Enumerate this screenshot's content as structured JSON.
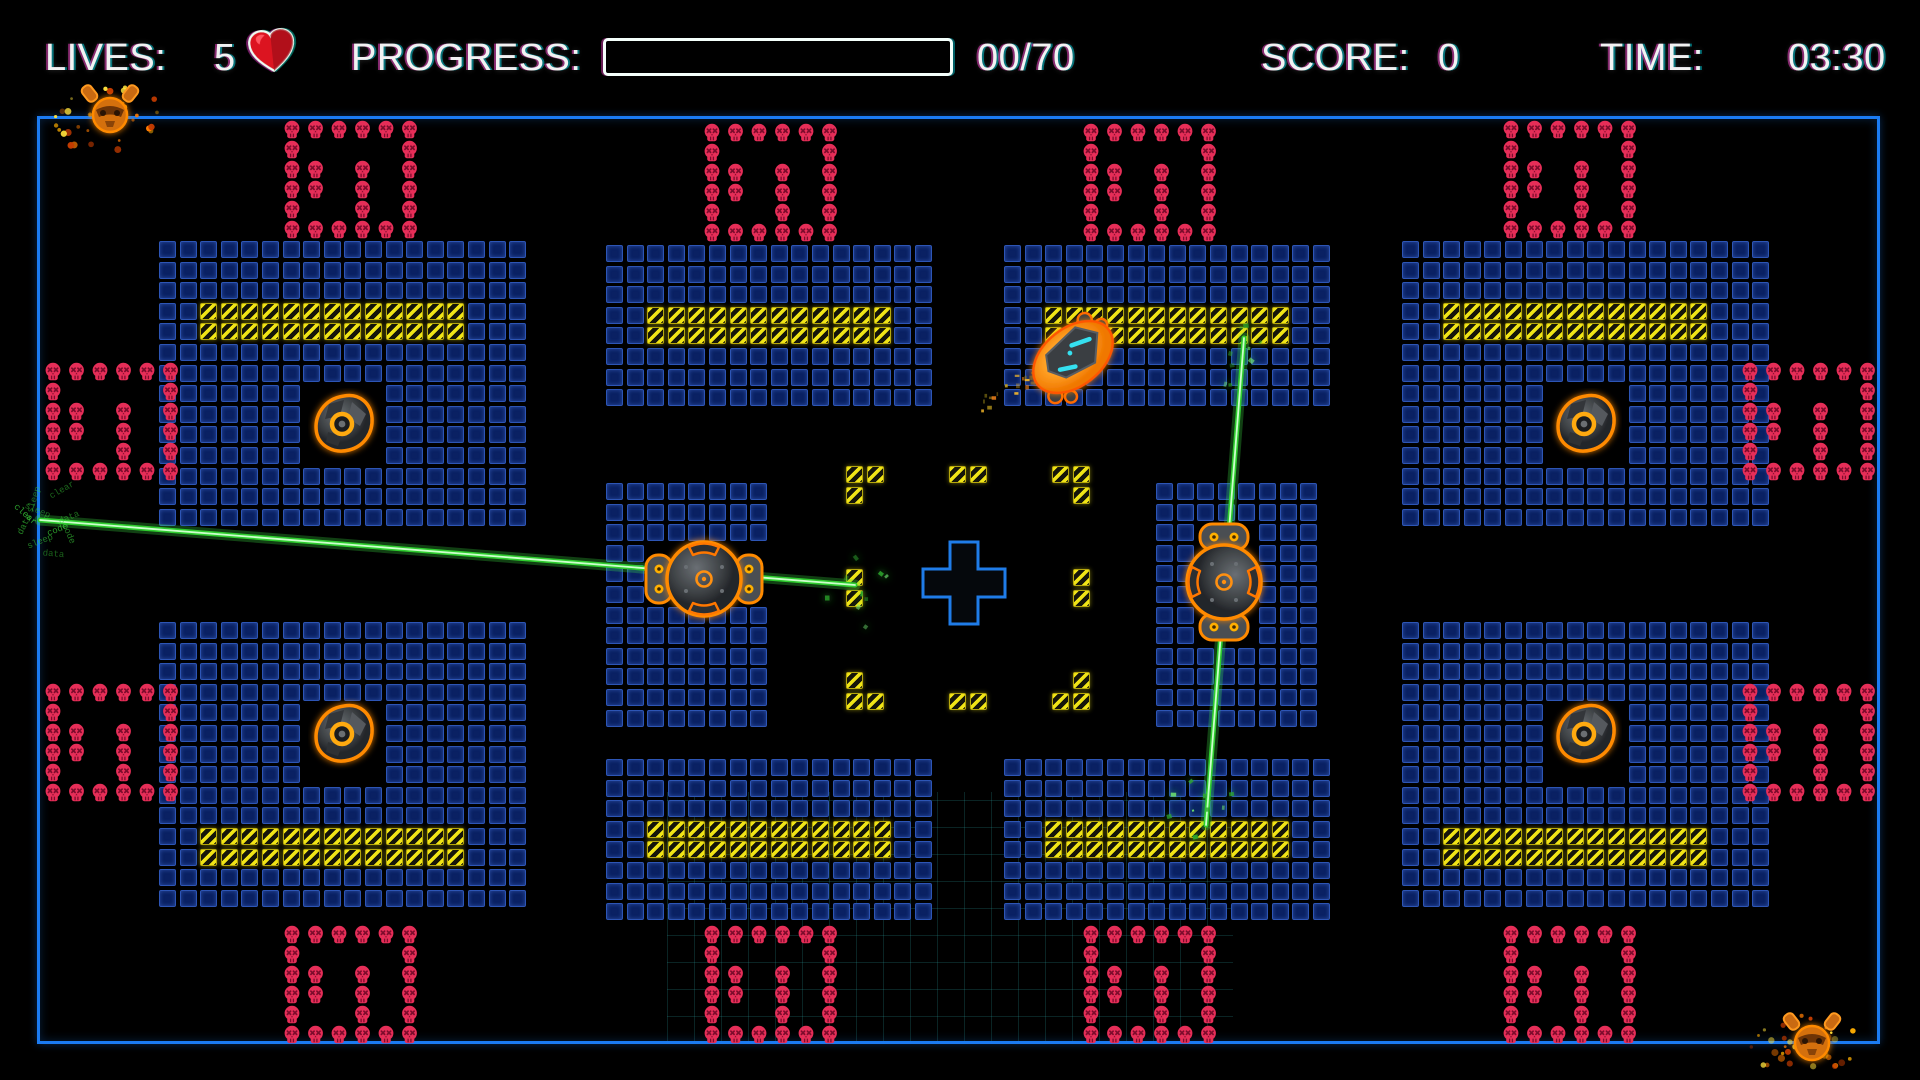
{
  "hud": {
    "lives_label": "LIVES:",
    "lives_value": "5",
    "heart_icon": "heart",
    "progress_label": "PROGRESS:",
    "progress_value": "00/70",
    "progress_fraction": 0,
    "score_label": "SCORE:",
    "score_value": "0",
    "time_label": "TIME:",
    "time_value": "03:30"
  },
  "colors": {
    "background": "#000000",
    "hud_text": "#f2f2f2",
    "field_border": "#1b7bf2",
    "tile_fill": "#0a2163",
    "tile_border": "#2d55b5",
    "hazard_yellow": "#f0e416",
    "hazard_dark": "#15150a",
    "skull": "#e62e58",
    "skull_detail": "#7d0c2c",
    "laser_green": "#2ecc2e",
    "enemy_gray": "#44484c",
    "enemy_outline": "#ff8a00",
    "player_orange": "#ffa024",
    "player_accent": "#35e0f0",
    "heart_red": "#dc1420",
    "grid_teal": "rgba(45,165,165,0.22)"
  },
  "field": {
    "x": 37,
    "y": 116,
    "w": 1843,
    "h": 928
  },
  "tile_pitch": 20.6,
  "tile_size": 17,
  "tile_blocks": [
    {
      "x": 159,
      "y": 241,
      "cols": 18,
      "rows": 14,
      "hazard": {
        "rows": [
          3,
          4
        ],
        "c0": 2,
        "c1": 14
      },
      "hole": {
        "r0": 7,
        "r1": 10,
        "c0": 7,
        "c1": 10
      }
    },
    {
      "x": 606,
      "y": 245,
      "cols": 16,
      "rows": 8,
      "hazard": {
        "rows": [
          3,
          4
        ],
        "c0": 2,
        "c1": 13
      }
    },
    {
      "x": 1004,
      "y": 245,
      "cols": 16,
      "rows": 8,
      "hazard": {
        "rows": [
          3,
          4
        ],
        "c0": 2,
        "c1": 13
      }
    },
    {
      "x": 1402,
      "y": 241,
      "cols": 18,
      "rows": 14,
      "hazard": {
        "rows": [
          3,
          4
        ],
        "c0": 2,
        "c1": 14
      },
      "hole": {
        "r0": 7,
        "r1": 10,
        "c0": 7,
        "c1": 10
      }
    },
    {
      "x": 606,
      "y": 483,
      "cols": 8,
      "rows": 12,
      "hole": {
        "r0": 3,
        "r1": 5,
        "c0": 2,
        "c1": 7
      }
    },
    {
      "x": 1156,
      "y": 483,
      "cols": 8,
      "rows": 12,
      "hole": {
        "r0": 2,
        "r1": 7,
        "c0": 2,
        "c1": 4
      }
    },
    {
      "x": 159,
      "y": 622,
      "cols": 18,
      "rows": 14,
      "hazard": {
        "rows": [
          10,
          11
        ],
        "c0": 2,
        "c1": 14
      },
      "hole": {
        "r0": 4,
        "r1": 7,
        "c0": 7,
        "c1": 10
      }
    },
    {
      "x": 606,
      "y": 759,
      "cols": 16,
      "rows": 8,
      "hazard": {
        "rows": [
          3,
          4
        ],
        "c0": 2,
        "c1": 13
      }
    },
    {
      "x": 1004,
      "y": 759,
      "cols": 16,
      "rows": 8,
      "hazard": {
        "rows": [
          3,
          4
        ],
        "c0": 2,
        "c1": 13
      }
    },
    {
      "x": 1402,
      "y": 622,
      "cols": 18,
      "rows": 14,
      "hazard": {
        "rows": [
          10,
          11
        ],
        "c0": 2,
        "c1": 14
      },
      "hole": {
        "r0": 4,
        "r1": 7,
        "c0": 7,
        "c1": 10
      }
    }
  ],
  "skull_pattern": [
    [
      1,
      1,
      1,
      1,
      1,
      1
    ],
    [
      1,
      0,
      0,
      0,
      0,
      1
    ],
    [
      1,
      1,
      0,
      1,
      0,
      1
    ],
    [
      1,
      1,
      0,
      1,
      0,
      1
    ],
    [
      1,
      0,
      0,
      1,
      0,
      1
    ],
    [
      1,
      1,
      1,
      1,
      1,
      1
    ]
  ],
  "skull_pitch_x": 23.5,
  "skull_pitch_y": 20,
  "skull_blocks": [
    {
      "x": 282,
      "y": 120
    },
    {
      "x": 702,
      "y": 123
    },
    {
      "x": 1081,
      "y": 123
    },
    {
      "x": 1501,
      "y": 120
    },
    {
      "x": 43,
      "y": 362
    },
    {
      "x": 43,
      "y": 683
    },
    {
      "x": 1740,
      "y": 362
    },
    {
      "x": 1740,
      "y": 683
    },
    {
      "x": 282,
      "y": 925
    },
    {
      "x": 702,
      "y": 925
    },
    {
      "x": 1081,
      "y": 925
    },
    {
      "x": 1501,
      "y": 925
    }
  ],
  "center_ring": {
    "x": 846,
    "y": 466,
    "pitch": 20.6,
    "tiles": [
      [
        0,
        0
      ],
      [
        1,
        0
      ],
      [
        0,
        1
      ],
      [
        5,
        0
      ],
      [
        6,
        0
      ],
      [
        10,
        0
      ],
      [
        11,
        0
      ],
      [
        11,
        1
      ],
      [
        0,
        5
      ],
      [
        0,
        6
      ],
      [
        11,
        5
      ],
      [
        11,
        6
      ],
      [
        0,
        10
      ],
      [
        0,
        11
      ],
      [
        1,
        11
      ],
      [
        5,
        11
      ],
      [
        6,
        11
      ],
      [
        11,
        10
      ],
      [
        10,
        11
      ],
      [
        11,
        11
      ]
    ]
  },
  "cross": {
    "cx": 964,
    "cy": 583,
    "size": 82,
    "arm": 28
  },
  "turrets": [
    {
      "x": 344,
      "y": 424
    },
    {
      "x": 1586,
      "y": 424
    },
    {
      "x": 344,
      "y": 734
    },
    {
      "x": 1586,
      "y": 734
    }
  ],
  "orb_enemies": [
    {
      "x": 704,
      "y": 579,
      "rot": 0
    },
    {
      "x": 1224,
      "y": 582,
      "rot": 90
    }
  ],
  "player": {
    "x": 1073,
    "y": 357,
    "rot": -38
  },
  "corner_creatures": [
    {
      "x": 110,
      "y": 112
    },
    {
      "x": 1812,
      "y": 1040
    }
  ],
  "lasers": [
    {
      "x1": 40,
      "y1": 520,
      "x2": 855,
      "y2": 585
    },
    {
      "x1": 1244,
      "y1": 338,
      "x2": 1206,
      "y2": 825
    }
  ],
  "impact_words": {
    "x": 52,
    "y": 522,
    "words": [
      "sleep",
      "data",
      "clear",
      "code"
    ]
  },
  "debris_clusters": [
    {
      "x": 1244,
      "y": 352
    },
    {
      "x": 1206,
      "y": 812
    },
    {
      "x": 858,
      "y": 586
    }
  ],
  "ship_trail": {
    "x1": 976,
    "y1": 402,
    "x2": 1046,
    "y2": 372
  },
  "grid_patch": {
    "x": 667,
    "y": 792,
    "w": 566,
    "h": 252,
    "cell": 27
  }
}
